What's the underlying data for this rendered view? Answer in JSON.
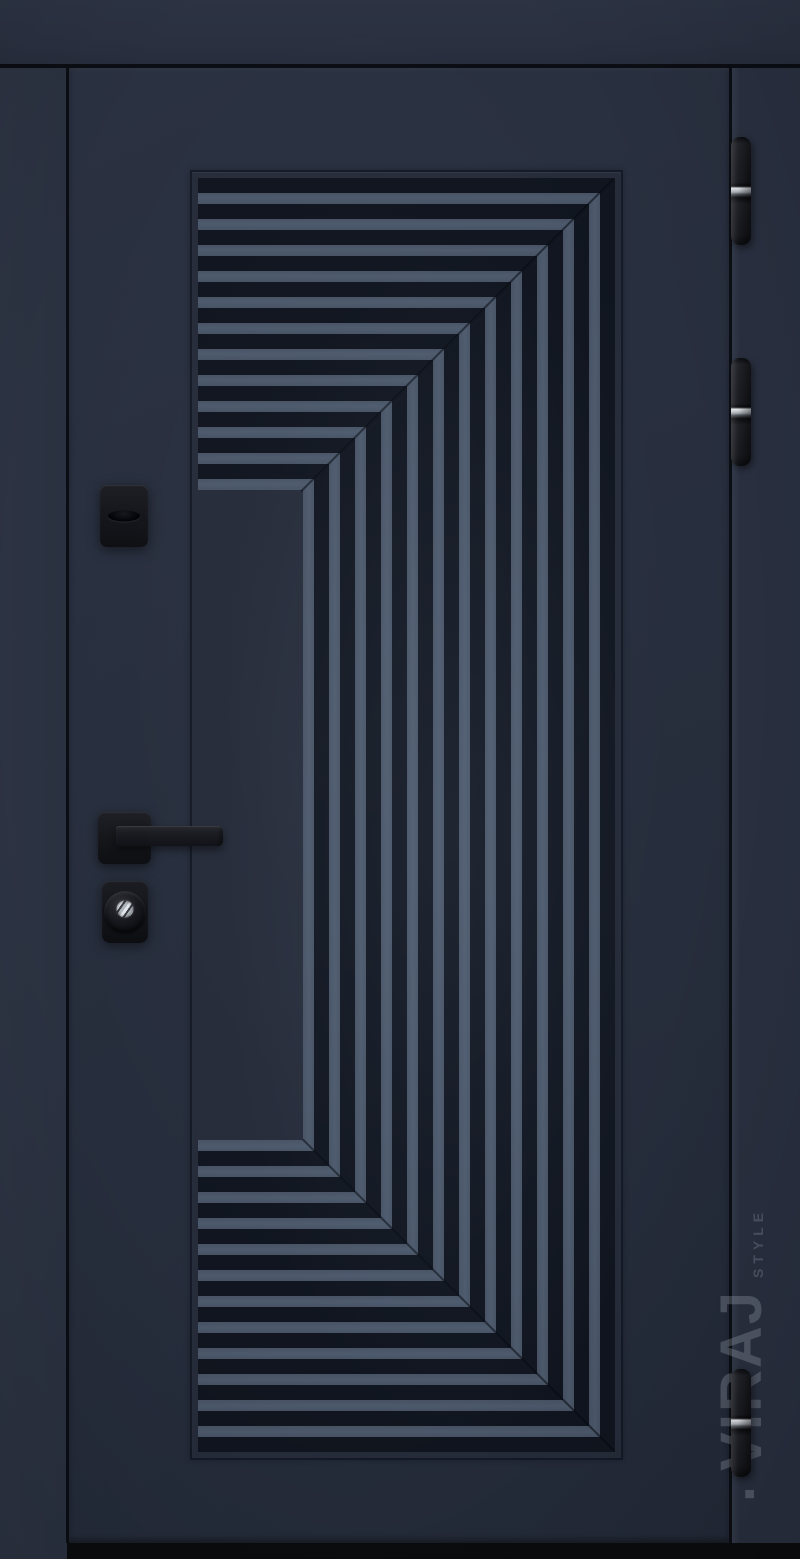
{
  "image": {
    "type": "product-photo",
    "subject": "entrance-door-dark-navy-with-ribbed-bracket-pattern"
  },
  "watermark": {
    "dot": "·",
    "brand": "VIRAJ",
    "style": "STYLE"
  },
  "door": {
    "hinge_count": 3,
    "hardware_items": [
      "key escutcheon",
      "lever handle on square rosette",
      "cylinder lock escutcheon"
    ],
    "colors": {
      "frame": "#2b3241",
      "transom": "#2b3343",
      "leaf": "#272e3d",
      "panel_flat": "#262c3a",
      "stripe_light": "#475364",
      "stripe_dark": "#10151f",
      "seam": "#0a0d13",
      "floor": "#0b0c0e",
      "hardware_black": "#141519",
      "hinge_ring_silver": "#c7cbd1",
      "watermark_gray": "rgba(172,182,196,0.30)"
    }
  }
}
